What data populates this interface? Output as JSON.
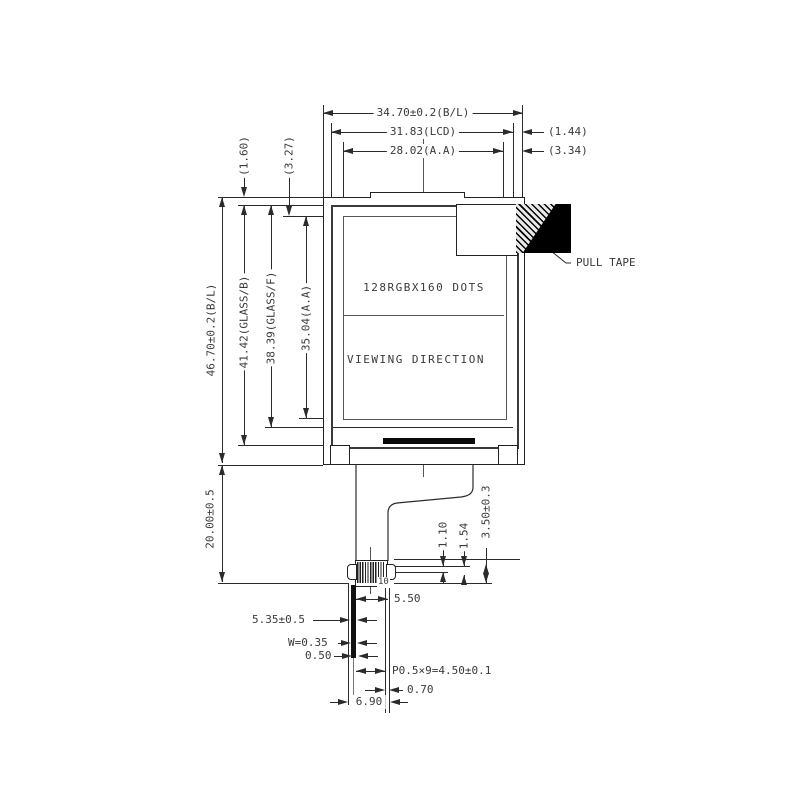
{
  "labels": {
    "top": {
      "bl_width": "34.70±0.2(B/L)",
      "lcd_width": "31.83(LCD)",
      "aa_width": "28.02(A.A)",
      "gap_lcd_right": "(1.44)",
      "gap_aa_right": "(3.34)"
    },
    "left": {
      "gap_glass_top": "(1.60)",
      "gap_aa_top": "(3.27)",
      "bl_height": "46.70±0.2(B/L)",
      "glass_back_height": "41.42(GLASS/B)",
      "glass_front_height": "38.39(GLASS/F)",
      "aa_height": "35.04(A.A)",
      "fpc_length": "20.00±0.5"
    },
    "screen": {
      "dots": "128RGBX160 DOTS",
      "viewing": "VIEWING DIRECTION"
    },
    "right": {
      "pull_tape": "PULL TAPE",
      "conn_total": "3.50±0.3",
      "conn_mid": "1.54",
      "conn_top": "1.10"
    },
    "bottom": {
      "tail_width": "5.50",
      "stiffener": "5.35±0.5",
      "pin_width": "W=0.35",
      "pin_gap": "0.50",
      "pin_pitch": "P0.5×9=4.50±0.1",
      "tail_gap": "0.70",
      "tail_total": "6.90",
      "pin_number": "10"
    }
  },
  "colors": {
    "line": "#2b2b2b",
    "tape": "#000000",
    "background": "#ffffff"
  }
}
